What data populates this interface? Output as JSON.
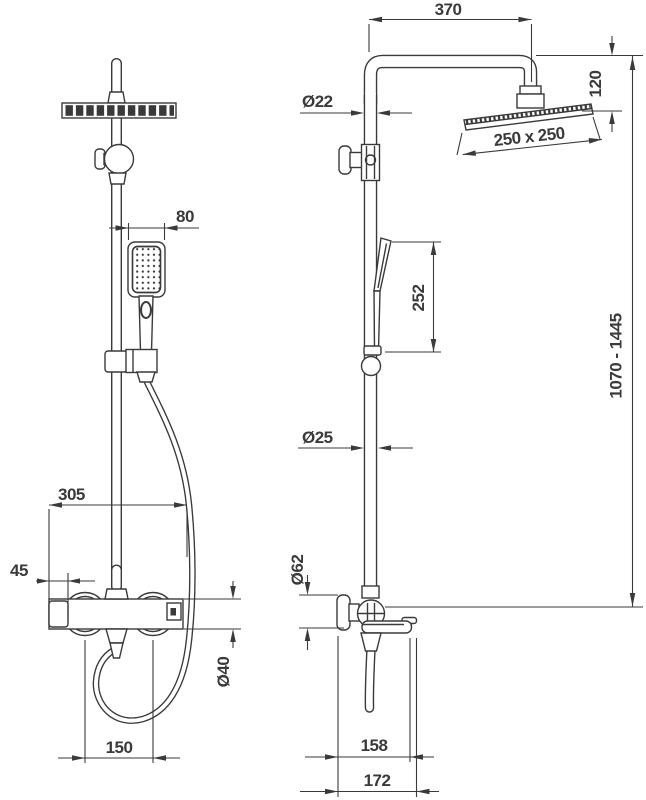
{
  "meta": {
    "type": "technical dimension drawing",
    "subject": "shower column set with overhead shower, hand shower and bath mixer",
    "views": [
      "front",
      "side"
    ]
  },
  "colors": {
    "line": "#3a3a3a",
    "background": "#ffffff"
  },
  "dims": {
    "front": {
      "hand_shower_width": "80",
      "mixer_width": "305",
      "union_offset": "45",
      "body_diameter": "Ø40",
      "union_spacing": "150"
    },
    "side": {
      "arm_reach": "370",
      "head_drop": "120",
      "head_size": "250 x 250",
      "pipe_upper_diameter": "Ø22",
      "hand_shower_travel": "252",
      "pipe_lower_diameter": "Ø25",
      "total_height": "1070 - 1445",
      "escutcheon_diameter": "Ø62",
      "spout_reach_inner": "158",
      "spout_reach_outer": "172"
    }
  }
}
